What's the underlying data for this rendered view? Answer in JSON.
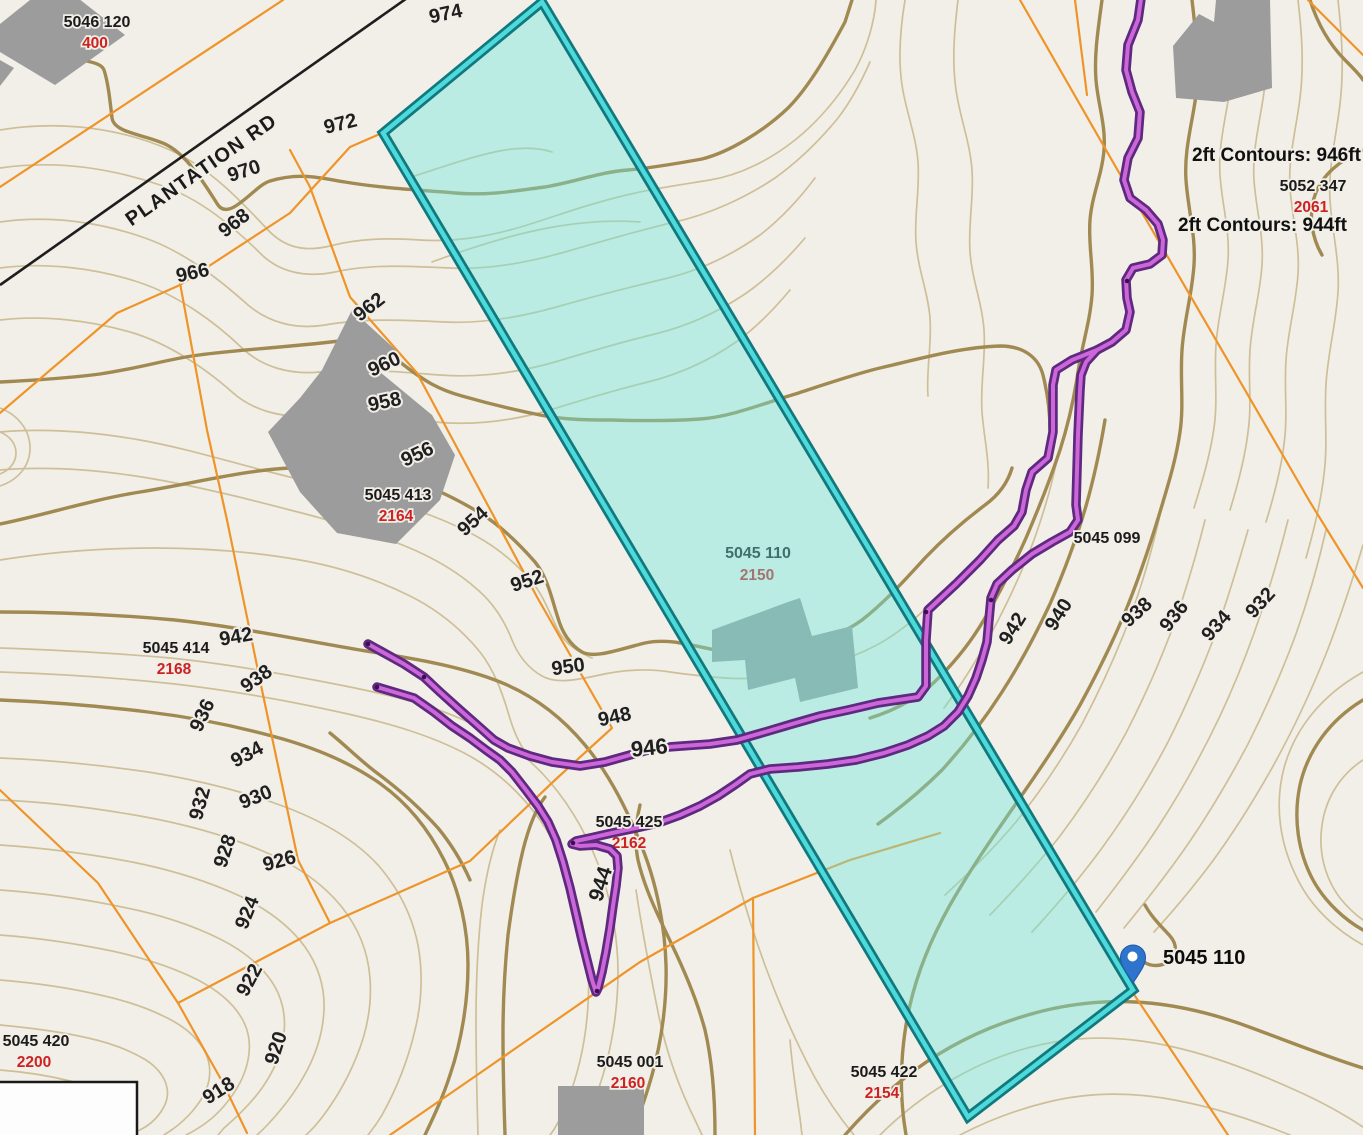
{
  "map": {
    "road": {
      "name": "PLANTATION RD"
    },
    "callouts": {
      "contour_946": "2ft Contours: 946ft",
      "contour_944": "2ft Contours: 944ft"
    },
    "selected_parcel": {
      "id": "5045 110",
      "lot": "2150",
      "pin_label": "5045 110"
    },
    "parcel_labels": [
      {
        "id": "5046 120",
        "addr": "400",
        "x": 97,
        "y": 27
      },
      {
        "id": "5052 347",
        "addr": "2061",
        "x": 1313,
        "y": 191
      },
      {
        "id": "5045 413",
        "addr": "2164",
        "x": 398,
        "y": 500
      },
      {
        "id": "5045 414",
        "addr": "2168",
        "x": 176,
        "y": 653
      },
      {
        "id": "5045 425",
        "addr": "",
        "x": 629,
        "y": 827
      },
      {
        "id": "5045 099",
        "addr": "",
        "x": 1107,
        "y": 543
      },
      {
        "id": "5045 001",
        "addr": "2160",
        "x": 630,
        "y": 1067
      },
      {
        "id": "5045 422",
        "addr": "2154",
        "x": 884,
        "y": 1077
      },
      {
        "id": "5045 420",
        "addr": "2200",
        "x": 36,
        "y": 1046
      }
    ],
    "hidden_address_2162": "2162",
    "contour_labels": [
      {
        "t": "974",
        "x": 447,
        "y": 20,
        "r": -12,
        "s": 20
      },
      {
        "t": "972",
        "x": 342,
        "y": 130,
        "r": -14,
        "s": 20
      },
      {
        "t": "970",
        "x": 246,
        "y": 177,
        "r": -18,
        "s": 20
      },
      {
        "t": "968",
        "x": 238,
        "y": 228,
        "r": -38,
        "s": 20
      },
      {
        "t": "966",
        "x": 194,
        "y": 279,
        "r": -12,
        "s": 20
      },
      {
        "t": "962",
        "x": 373,
        "y": 312,
        "r": -38,
        "s": 20
      },
      {
        "t": "960",
        "x": 387,
        "y": 370,
        "r": -25,
        "s": 20
      },
      {
        "t": "958",
        "x": 386,
        "y": 408,
        "r": -12,
        "s": 20
      },
      {
        "t": "956",
        "x": 420,
        "y": 460,
        "r": -25,
        "s": 20
      },
      {
        "t": "954",
        "x": 477,
        "y": 526,
        "r": -42,
        "s": 20
      },
      {
        "t": "952",
        "x": 529,
        "y": 587,
        "r": -18,
        "s": 20
      },
      {
        "t": "950",
        "x": 569,
        "y": 673,
        "r": -8,
        "s": 20
      },
      {
        "t": "948",
        "x": 616,
        "y": 723,
        "r": -12,
        "s": 20
      },
      {
        "t": "946",
        "x": 650,
        "y": 755,
        "r": -6,
        "s": 22
      },
      {
        "t": "944",
        "x": 607,
        "y": 886,
        "r": -72,
        "s": 21
      },
      {
        "t": "942",
        "x": 237,
        "y": 643,
        "r": -10,
        "s": 20
      },
      {
        "t": "938",
        "x": 260,
        "y": 684,
        "r": -35,
        "s": 20
      },
      {
        "t": "936",
        "x": 208,
        "y": 718,
        "r": -65,
        "s": 20
      },
      {
        "t": "934",
        "x": 250,
        "y": 760,
        "r": -28,
        "s": 20
      },
      {
        "t": "930",
        "x": 258,
        "y": 803,
        "r": -22,
        "s": 20
      },
      {
        "t": "932",
        "x": 206,
        "y": 805,
        "r": -75,
        "s": 20
      },
      {
        "t": "928",
        "x": 231,
        "y": 853,
        "r": -72,
        "s": 20
      },
      {
        "t": "926",
        "x": 281,
        "y": 867,
        "r": -15,
        "s": 20
      },
      {
        "t": "924",
        "x": 253,
        "y": 915,
        "r": -68,
        "s": 20
      },
      {
        "t": "922",
        "x": 255,
        "y": 983,
        "r": -62,
        "s": 20
      },
      {
        "t": "920",
        "x": 282,
        "y": 1050,
        "r": -72,
        "s": 20
      },
      {
        "t": "918",
        "x": 222,
        "y": 1096,
        "r": -32,
        "s": 20
      },
      {
        "t": "942",
        "x": 1018,
        "y": 632,
        "r": -58,
        "s": 20
      },
      {
        "t": "940",
        "x": 1064,
        "y": 618,
        "r": -58,
        "s": 20
      },
      {
        "t": "938",
        "x": 1141,
        "y": 617,
        "r": -42,
        "s": 20
      },
      {
        "t": "936",
        "x": 1179,
        "y": 620,
        "r": -52,
        "s": 20
      },
      {
        "t": "934",
        "x": 1221,
        "y": 630,
        "r": -48,
        "s": 20
      },
      {
        "t": "932",
        "x": 1265,
        "y": 607,
        "r": -48,
        "s": 20
      }
    ],
    "colors": {
      "background": "#f2efe8",
      "contour_thin": "#cdbf97",
      "contour_index": "#a18a52",
      "parcel_line": "#ef9428",
      "road": "#1e1e1e",
      "building": "#9c9c9c",
      "highlight_fill": "#6ee8dc",
      "highlight_border_outer": "#11787e",
      "highlight_border_inner": "#4ed9da",
      "trail_outer": "#5d2a80",
      "trail_inner": "#cd66d8",
      "pin": "#2e74cc",
      "label_text": "#1b1b1b",
      "address_text": "#cc2222"
    }
  }
}
